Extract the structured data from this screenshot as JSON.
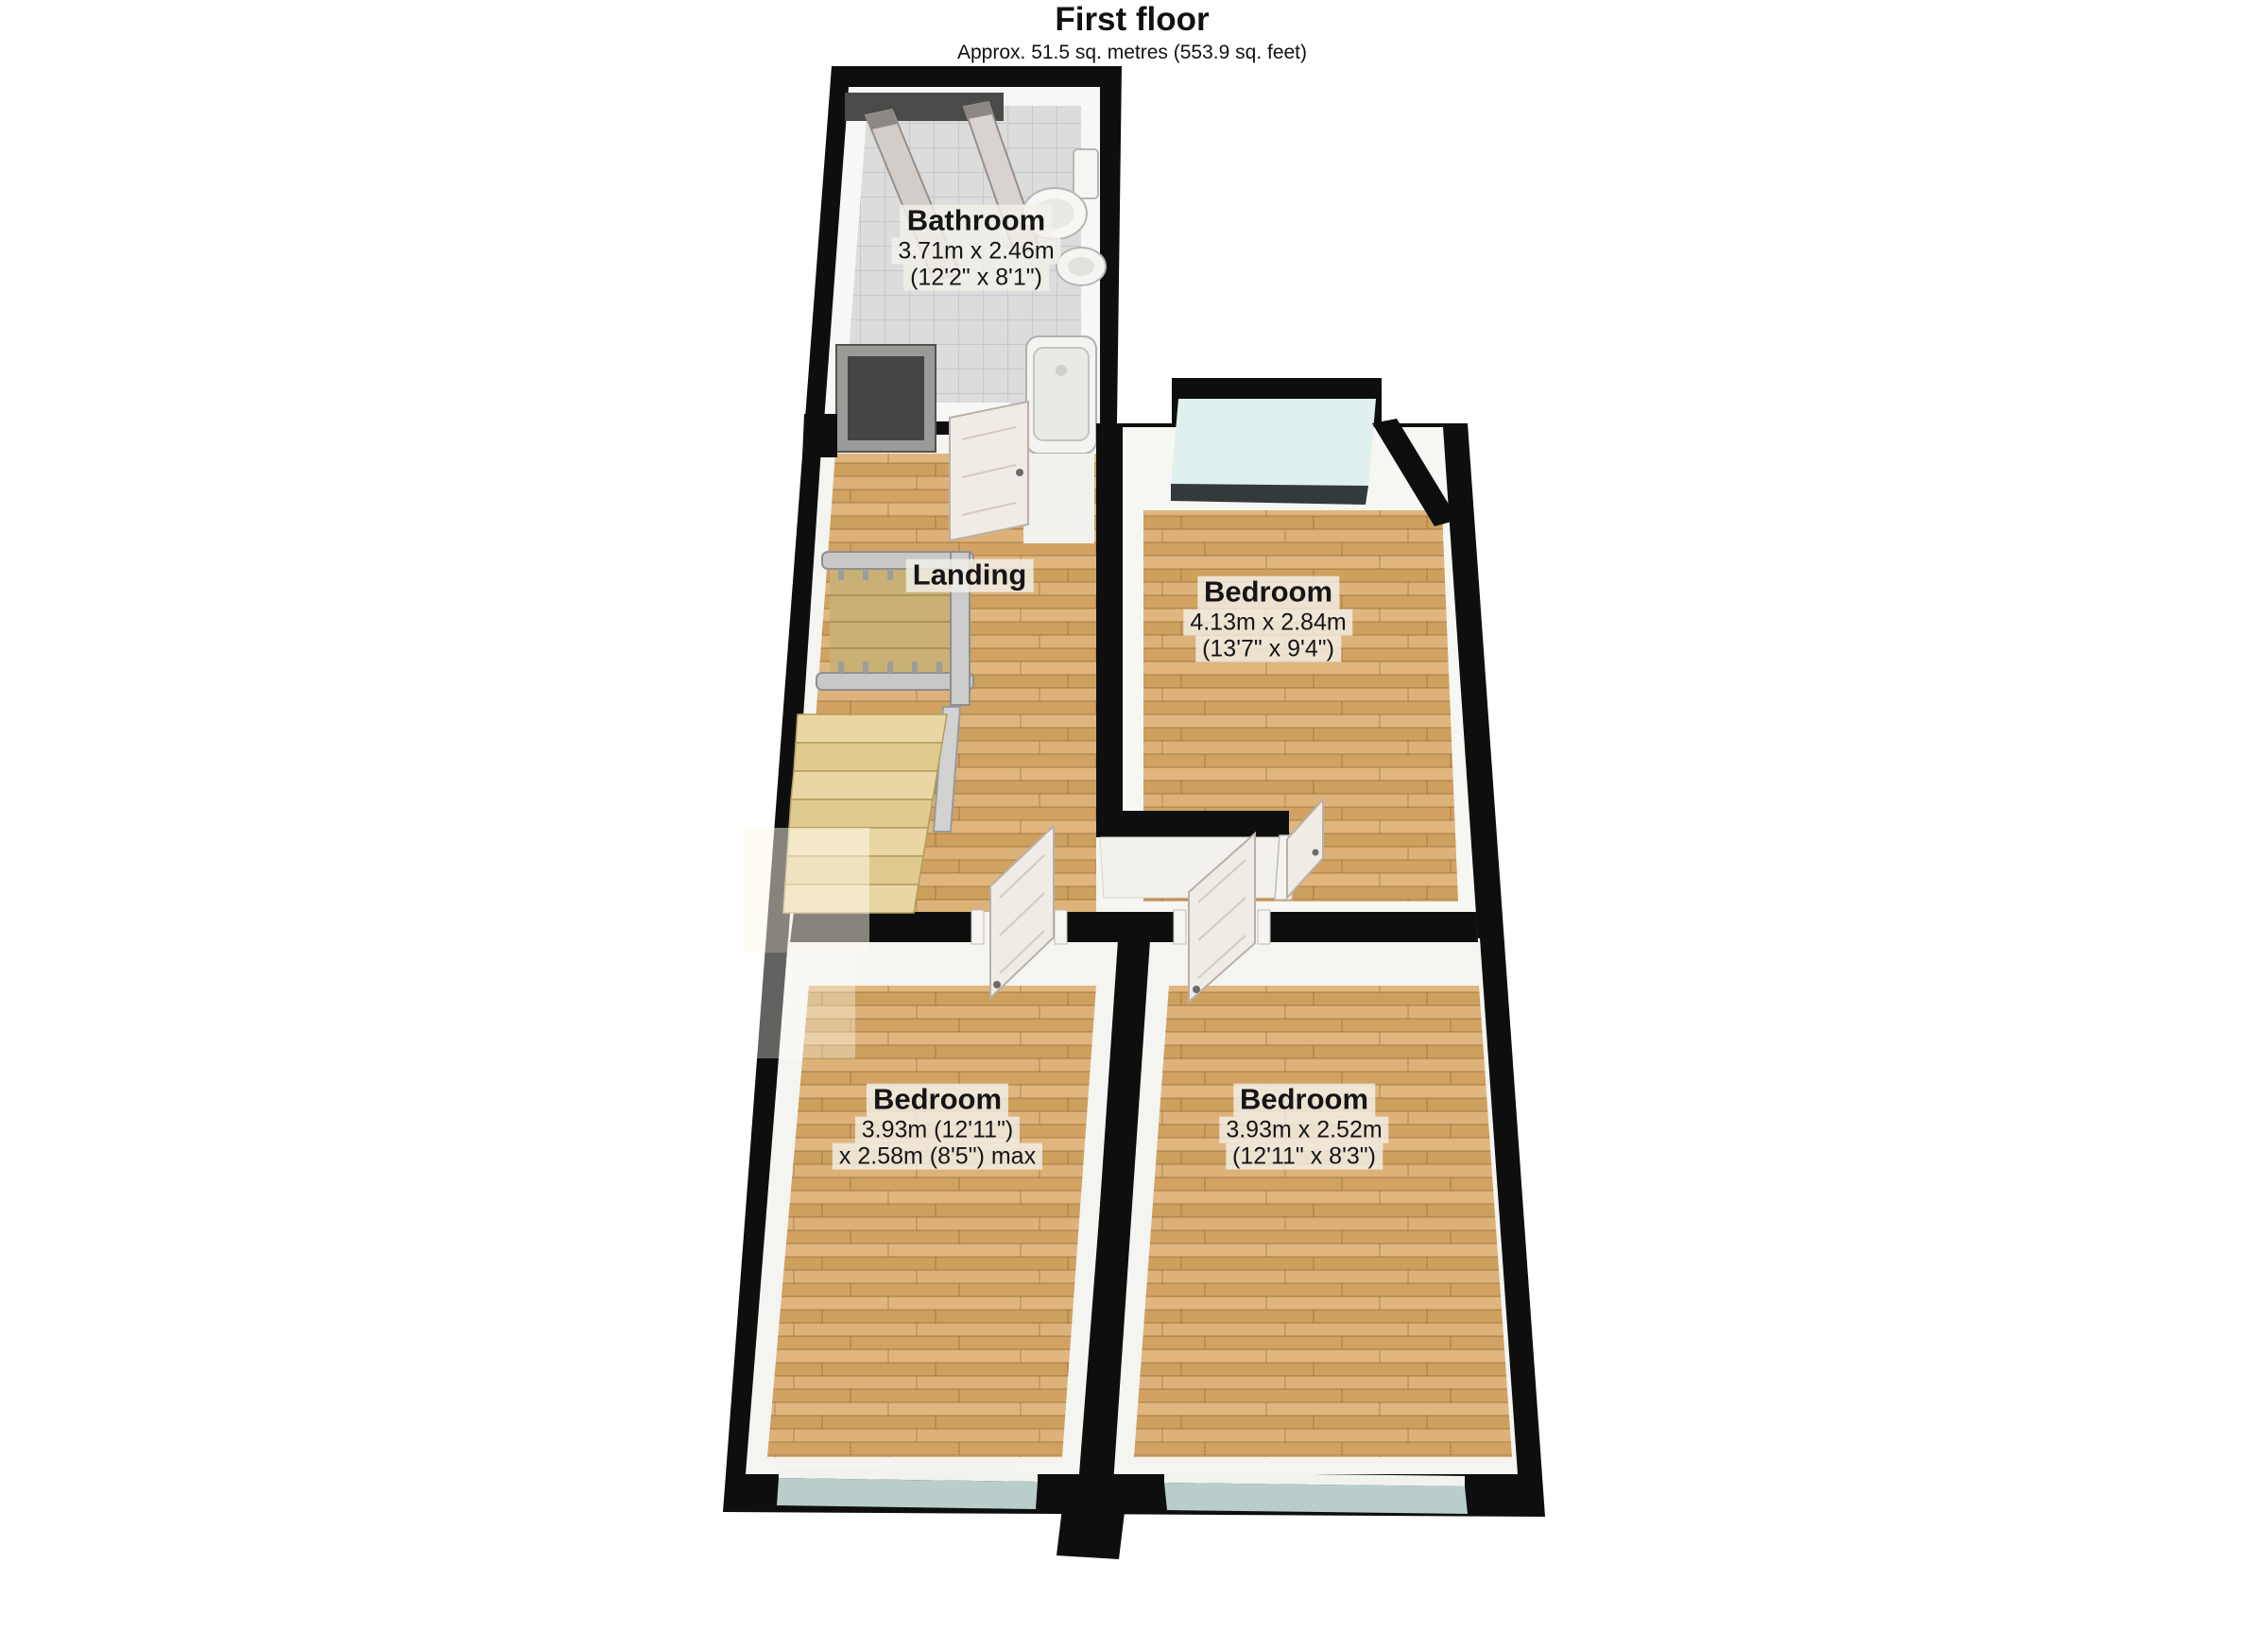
{
  "title": "First floor",
  "subtitle": "Approx. 51.5 sq. metres (553.9 sq. feet)",
  "rooms": {
    "bathroom": {
      "name": "Bathroom",
      "dims1": "3.71m x 2.46m",
      "dims2": "(12'2\" x 8'1\")"
    },
    "landing": {
      "name": "Landing"
    },
    "bedroom_top_right": {
      "name": "Bedroom",
      "dims1": "4.13m x 2.84m",
      "dims2": "(13'7\" x 9'4\")"
    },
    "bedroom_bottom_left": {
      "name": "Bedroom",
      "dims1": "3.93m (12'11\")",
      "dims2": "x 2.58m (8'5\") max"
    },
    "bedroom_bottom_right": {
      "name": "Bedroom",
      "dims1": "3.93m x 2.52m",
      "dims2": "(12'11\" x 8'3\")"
    }
  },
  "colors": {
    "wall": "#0e0e0e",
    "wood_floor": "#d6a76c",
    "bathroom_tile": "#dadada",
    "window_glass": "#dff0ef",
    "window_strip": "#b9cecb",
    "stair_tread": "#e8d5a0",
    "railing": "#c8c8c8",
    "label_background": "#f1eee8"
  }
}
